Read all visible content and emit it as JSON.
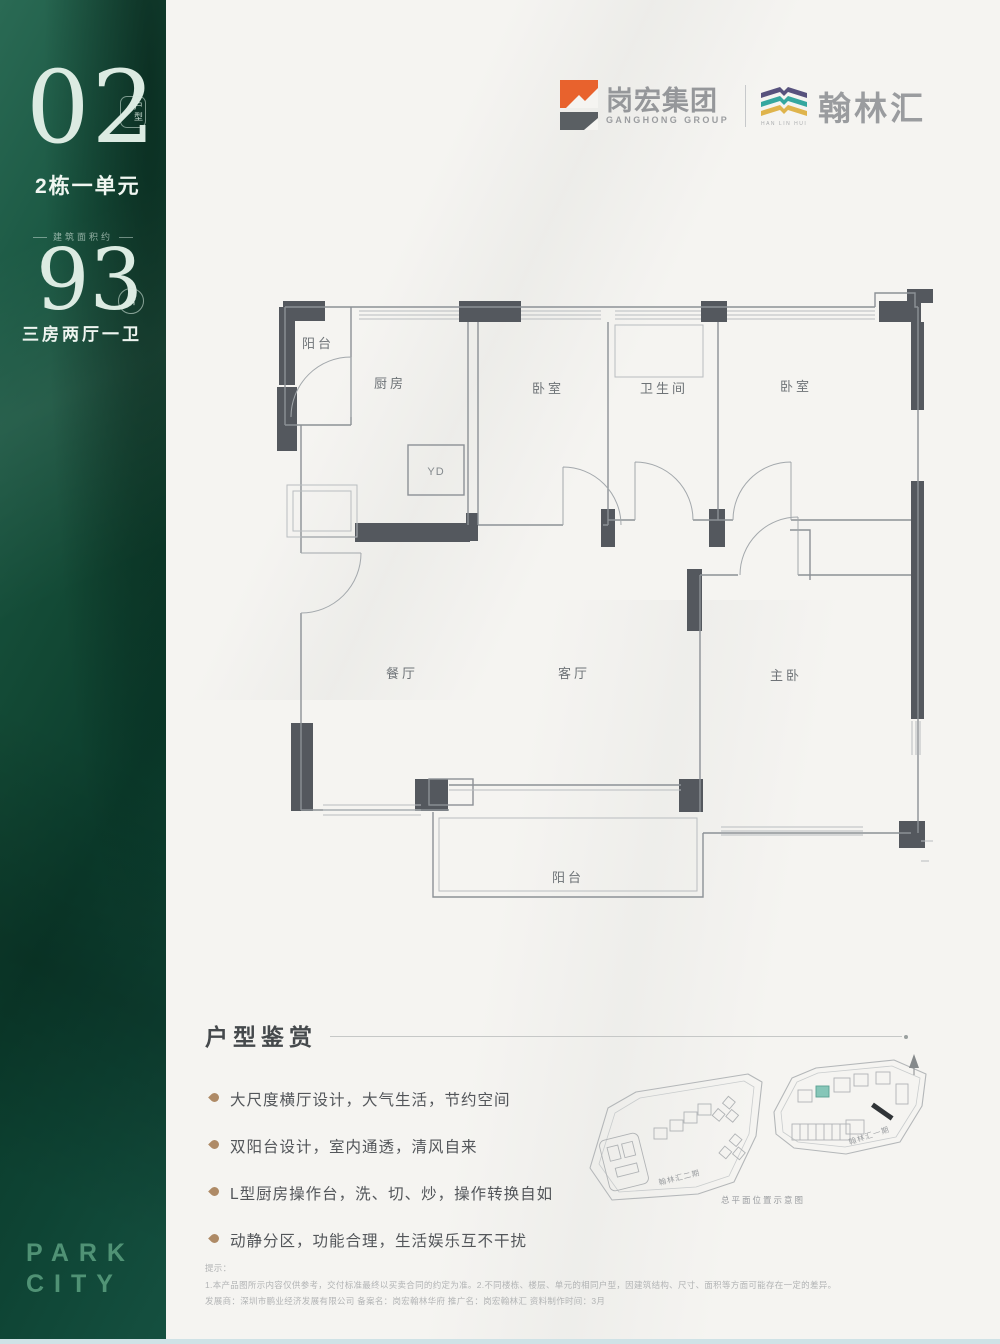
{
  "sidebar": {
    "unit_number": "02",
    "unit_badge": "户型",
    "unit_label": "2栋一单元",
    "area_caption": "建筑面积约",
    "area_value": "93",
    "area_unit": "㎡",
    "layout_label": "三房两厅一卫",
    "brand_line1": "PARK",
    "brand_line2": "CITY",
    "green": "#0e4434"
  },
  "header": {
    "logo1_name": "岗宏集团",
    "logo1_sub": "GANGHONG GROUP",
    "logo1_orange": "#e8622d",
    "logo1_gray": "#5a5f63",
    "logo2_name": "翰林汇",
    "logo2_sub": "HAN LIN HUI",
    "logo2_purple": "#57527d",
    "logo2_teal": "#35a79f",
    "logo2_yellow": "#dfb44c"
  },
  "floorplan": {
    "labels": {
      "balcony_top": "阳台",
      "kitchen": "厨房",
      "duct": "YD",
      "bedroom_a": "卧室",
      "bathroom": "卫生间",
      "bedroom_b": "卧室",
      "dining": "餐厅",
      "living": "客厅",
      "master": "主卧",
      "balcony_bottom": "阳台"
    }
  },
  "section": {
    "title": "户型鉴赏",
    "bullets": [
      "大尺度横厅设计，大气生活，节约空间",
      "双阳台设计，室内通透，清风自来",
      "L型厨房操作台，洗、切、炒，操作转换自如",
      "动静分区，功能合理，生活娱乐互不干扰"
    ]
  },
  "siteplan": {
    "label_left": "翰林汇二期",
    "label_right": "翰林汇一期",
    "caption": "总平面位置示意图",
    "highlight_color": "#86c6b8"
  },
  "disclaimer": {
    "line0": "提示：",
    "line1": "1.本产品图所示内容仅供参考，交付标准最终以买卖合同的约定为准。2.不同楼栋、楼层、单元的相同户型，因建筑结构、尺寸、面积等方面可能存在一定的差异。",
    "line2": "发展商：深圳市鹏业经济发展有限公司 备案名：岗宏翰林华府 推广名：岗宏翰林汇 资料制作时间：3月"
  }
}
